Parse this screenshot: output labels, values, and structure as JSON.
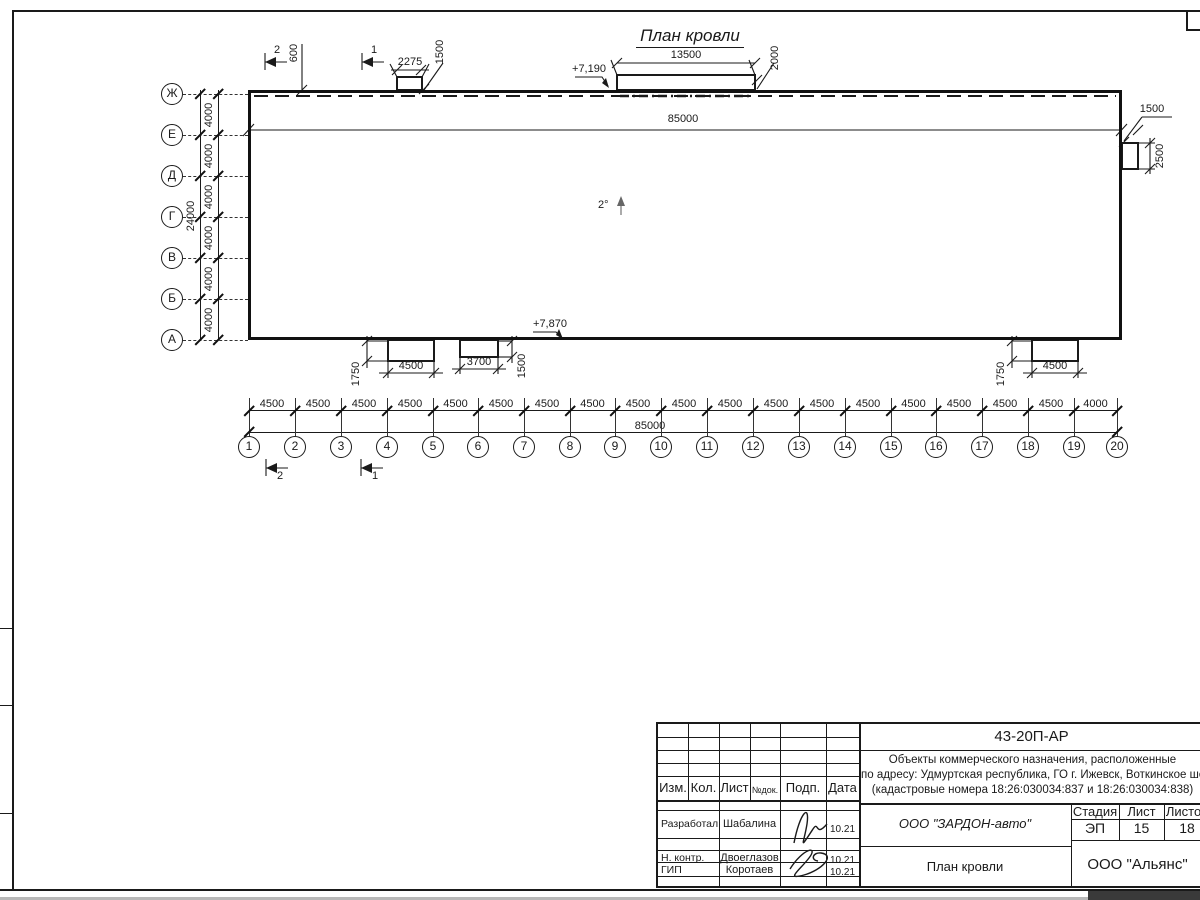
{
  "drawing": {
    "title": "План кровли",
    "dims": {
      "total_top": "85000",
      "slope": "2°",
      "elev_top": "+7,190",
      "elev_bottom": "+7,870",
      "sec_2": "2",
      "sec_1": "1",
      "d600": "600",
      "d2275": "2275",
      "d1500_top": "1500",
      "d13500": "13500",
      "d2000": "2000",
      "d1500_right": "1500",
      "d2500_right": "2500",
      "d1750_a": "1750",
      "d4500_a": "4500",
      "d3700_b": "3700",
      "d1500_b": "1500",
      "d1750_c": "1750",
      "d4500_c": "4500",
      "total_bottom": "85000",
      "row_total": "24000"
    },
    "plan": {
      "col_axes": [
        {
          "label": "1",
          "x": 249
        },
        {
          "label": "2",
          "x": 295
        },
        {
          "label": "3",
          "x": 341
        },
        {
          "label": "4",
          "x": 387
        },
        {
          "label": "5",
          "x": 433
        },
        {
          "label": "6",
          "x": 478
        },
        {
          "label": "7",
          "x": 524
        },
        {
          "label": "8",
          "x": 570
        },
        {
          "label": "9",
          "x": 615
        },
        {
          "label": "10",
          "x": 661
        },
        {
          "label": "11",
          "x": 707
        },
        {
          "label": "12",
          "x": 753
        },
        {
          "label": "13",
          "x": 799
        },
        {
          "label": "14",
          "x": 845
        },
        {
          "label": "15",
          "x": 891
        },
        {
          "label": "16",
          "x": 936
        },
        {
          "label": "17",
          "x": 982
        },
        {
          "label": "18",
          "x": 1028
        },
        {
          "label": "19",
          "x": 1074
        },
        {
          "label": "20",
          "x": 1117
        }
      ],
      "col_spacing_labels": [
        "4500",
        "4500",
        "4500",
        "4500",
        "4500",
        "4500",
        "4500",
        "4500",
        "4500",
        "4500",
        "4500",
        "4500",
        "4500",
        "4500",
        "4500",
        "4500",
        "4500",
        "4500",
        "4000"
      ],
      "row_axes": [
        {
          "label": "Ж",
          "y": 94
        },
        {
          "label": "Е",
          "y": 135
        },
        {
          "label": "Д",
          "y": 176
        },
        {
          "label": "Г",
          "y": 217
        },
        {
          "label": "В",
          "y": 258
        },
        {
          "label": "Б",
          "y": 299
        },
        {
          "label": "А",
          "y": 340
        }
      ],
      "row_spacing_label": "4000"
    }
  },
  "titleblock": {
    "doc_number": "43-20П-АР",
    "address_lines": [
      "Объекты коммерческого назначения, расположенные",
      "по адресу: Удмуртская республика, ГО г. Ижевск, Воткинское шоссе",
      "(кадастровые номера 18:26:030034:837 и 18:26:030034:838)"
    ],
    "header": [
      "Изм.",
      "Кол.",
      "Лист",
      "№док.",
      "Подп.",
      "Дата"
    ],
    "rows": [
      {
        "role": "Разработал",
        "name": "Шабалина",
        "date": "10.21"
      },
      {
        "role": "Н. контр.",
        "name": "Двоеглазов",
        "date": "10.21"
      },
      {
        "role": "ГИП",
        "name": "Коротаев",
        "date": "10.21"
      }
    ],
    "customer": "ООО \"ЗАРДОН-авто\"",
    "sheet_name": "План кровли",
    "org": "ООО \"Альянс\"",
    "stage_header": [
      "Стадия",
      "Лист",
      "Листов"
    ],
    "stage": "ЭП",
    "sheet": "15",
    "sheets": "18"
  }
}
